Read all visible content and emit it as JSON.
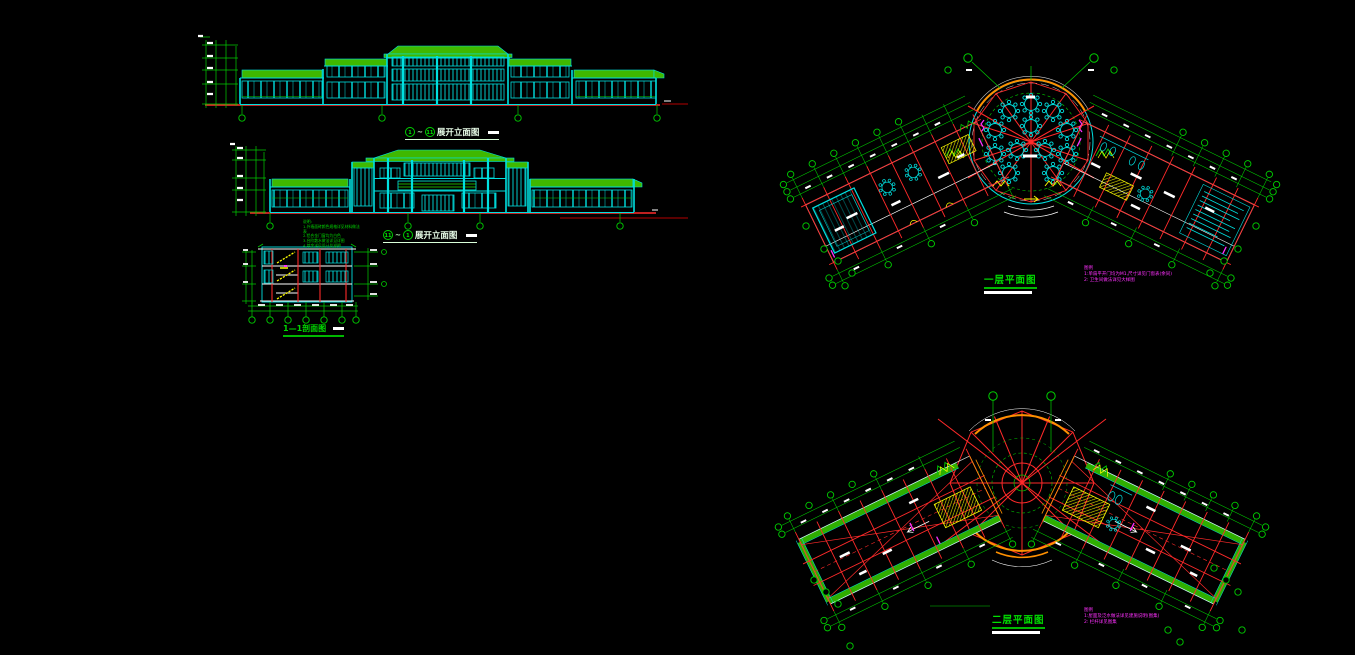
{
  "app": {
    "name": "CAD drawing canvas",
    "background": "#000000"
  },
  "palette": {
    "cyan": "#00E0E0",
    "green": "#00CC00",
    "roof_band_fill": "#3FB800",
    "red": "#FF2A2A",
    "dark_red": "#B40000",
    "yellow": "#FFFF00",
    "orange": "#FF9000",
    "magenta": "#FF30FF",
    "white": "#FFFFFF"
  },
  "drawings": {
    "elevation_a": {
      "axis_start": "1",
      "separator": "~",
      "axis_end": "11",
      "title": "展开立面图"
    },
    "elevation_b": {
      "axis_start": "11",
      "separator": "~",
      "axis_end": "1",
      "title": "展开立面图"
    },
    "section": {
      "title": "1—1剖面图"
    },
    "plan_first": {
      "title": "一层平面图",
      "legend_heading": "图例",
      "legend_items": [
        "1:单扇平开门均为M1,尺寸详见门窗表(余同)",
        "2: 卫生间做法详见大样图"
      ]
    },
    "plan_second": {
      "title": "二层平面图",
      "legend_heading": "图例",
      "legend_items": [
        "1:屋面及泛水做法详见建施说明(图集)",
        "2: 栏杆详见图集"
      ]
    },
    "general_notes": {
      "lines": [
        "说明:",
        "1.外墙面砖颜色规格详见材料做法表",
        "2.铝合金门窗均为白色",
        "3.台阶散水做法详见详图",
        "4.其余详见设计总说明"
      ]
    }
  }
}
